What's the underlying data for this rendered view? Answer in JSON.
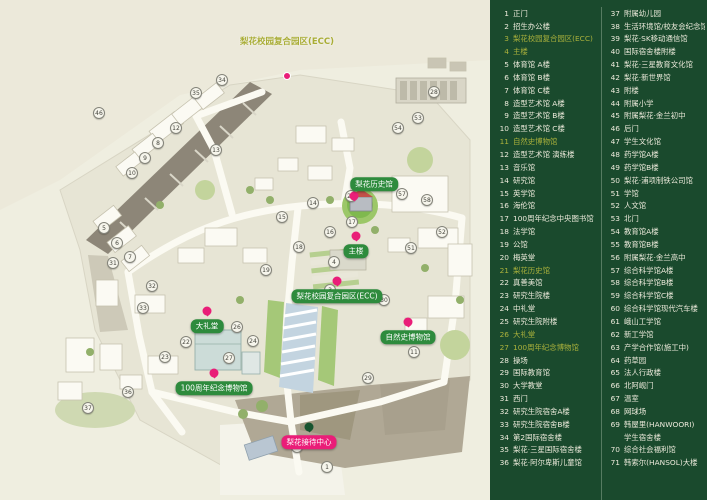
{
  "title": "梨花女子大学校园地图",
  "colors": {
    "map_bg": "#efeee0",
    "legend_bg": "#1a4a2d",
    "legend_text": "#eceadb",
    "legend_highlight": "#abb13c",
    "badge_green": "#2e8b3d",
    "badge_pink": "#ea1d78",
    "pin_pink": "#e91e78",
    "pin_green": "#17542f",
    "road": "#fbfaf2",
    "dark_band": "#8d8678",
    "lawn_green": "#7fb94e"
  },
  "map": {
    "top_label": "梨花校园复合园区(ECC)",
    "badges": [
      {
        "label": "梨花历史馆",
        "x": 374,
        "y": 184,
        "style": "green",
        "pin": "below",
        "pin_color": "pink"
      },
      {
        "label": "主楼",
        "x": 356,
        "y": 251,
        "style": "green",
        "pin": "above",
        "pin_color": "pink"
      },
      {
        "label": "梨花校园复合园区(ECC)",
        "x": 337,
        "y": 296,
        "style": "green",
        "pin": "above",
        "pin_color": "pink"
      },
      {
        "label": "大礼堂",
        "x": 207,
        "y": 326,
        "style": "green",
        "pin": "above",
        "pin_color": "pink"
      },
      {
        "label": "自然史博物馆",
        "x": 408,
        "y": 337,
        "style": "green",
        "pin": "above",
        "pin_color": "pink"
      },
      {
        "label": "100周年纪念博物馆",
        "x": 214,
        "y": 388,
        "style": "green",
        "pin": "above",
        "pin_color": "pink"
      },
      {
        "label": "梨花接待中心",
        "x": 309,
        "y": 442,
        "style": "pink",
        "pin": "above",
        "pin_color": "green"
      }
    ],
    "markers": [
      {
        "n": "46",
        "x": 99,
        "y": 113
      },
      {
        "n": "34",
        "x": 222,
        "y": 80
      },
      {
        "n": "35",
        "x": 196,
        "y": 93
      },
      {
        "n": "12",
        "x": 176,
        "y": 128
      },
      {
        "n": "8",
        "x": 158,
        "y": 143
      },
      {
        "n": "9",
        "x": 145,
        "y": 158
      },
      {
        "n": "10",
        "x": 132,
        "y": 173
      },
      {
        "n": "13",
        "x": 216,
        "y": 150
      },
      {
        "n": "5",
        "x": 104,
        "y": 228
      },
      {
        "n": "6",
        "x": 117,
        "y": 243
      },
      {
        "n": "7",
        "x": 130,
        "y": 257
      },
      {
        "n": "31",
        "x": 113,
        "y": 263
      },
      {
        "n": "32",
        "x": 152,
        "y": 286
      },
      {
        "n": "33",
        "x": 143,
        "y": 308
      },
      {
        "n": "14",
        "x": 313,
        "y": 203
      },
      {
        "n": "21",
        "x": 351,
        "y": 196
      },
      {
        "n": "17",
        "x": 352,
        "y": 222
      },
      {
        "n": "15",
        "x": 282,
        "y": 217
      },
      {
        "n": "16",
        "x": 330,
        "y": 232
      },
      {
        "n": "18",
        "x": 299,
        "y": 247
      },
      {
        "n": "4",
        "x": 334,
        "y": 262
      },
      {
        "n": "19",
        "x": 266,
        "y": 270
      },
      {
        "n": "54",
        "x": 398,
        "y": 128
      },
      {
        "n": "53",
        "x": 418,
        "y": 118
      },
      {
        "n": "28",
        "x": 434,
        "y": 92
      },
      {
        "n": "57",
        "x": 402,
        "y": 194
      },
      {
        "n": "58",
        "x": 427,
        "y": 200
      },
      {
        "n": "52",
        "x": 442,
        "y": 232
      },
      {
        "n": "51",
        "x": 411,
        "y": 248
      },
      {
        "n": "30",
        "x": 384,
        "y": 300
      },
      {
        "n": "29",
        "x": 368,
        "y": 378
      },
      {
        "n": "11",
        "x": 414,
        "y": 352
      },
      {
        "n": "26",
        "x": 237,
        "y": 327
      },
      {
        "n": "24",
        "x": 253,
        "y": 341
      },
      {
        "n": "27",
        "x": 229,
        "y": 358
      },
      {
        "n": "22",
        "x": 186,
        "y": 342
      },
      {
        "n": "23",
        "x": 165,
        "y": 357
      },
      {
        "n": "36",
        "x": 128,
        "y": 392
      },
      {
        "n": "37",
        "x": 88,
        "y": 408
      },
      {
        "n": "2",
        "x": 297,
        "y": 447
      },
      {
        "n": "1",
        "x": 327,
        "y": 467
      },
      {
        "n": "3",
        "x": 330,
        "y": 290
      }
    ]
  },
  "legend": {
    "columns": [
      {
        "items": [
          {
            "n": "1",
            "label": "正门",
            "hl": false
          },
          {
            "n": "2",
            "label": "招生办公楼",
            "hl": false
          },
          {
            "n": "3",
            "label": "梨花校园复合园区(ECC)",
            "hl": true
          },
          {
            "n": "4",
            "label": "主楼",
            "hl": true
          },
          {
            "n": "5",
            "label": "体育馆 A楼",
            "hl": false
          },
          {
            "n": "6",
            "label": "体育馆 B楼",
            "hl": false
          },
          {
            "n": "7",
            "label": "体育馆 C楼",
            "hl": false
          },
          {
            "n": "8",
            "label": "造型艺术馆 A楼",
            "hl": false
          },
          {
            "n": "9",
            "label": "造型艺术馆 B楼",
            "hl": false
          },
          {
            "n": "10",
            "label": "造型艺术馆 C楼",
            "hl": false
          },
          {
            "n": "11",
            "label": "自然史博物馆",
            "hl": true
          },
          {
            "n": "12",
            "label": "造型艺术馆 演练楼",
            "hl": false
          },
          {
            "n": "13",
            "label": "音乐馆",
            "hl": false
          },
          {
            "n": "14",
            "label": "研究馆",
            "hl": false
          },
          {
            "n": "15",
            "label": "英学馆",
            "hl": false
          },
          {
            "n": "16",
            "label": "海伦馆",
            "hl": false
          },
          {
            "n": "17",
            "label": "100周年纪念中央图书馆",
            "hl": false
          },
          {
            "n": "18",
            "label": "法学馆",
            "hl": false
          },
          {
            "n": "19",
            "label": "公馆",
            "hl": false
          },
          {
            "n": "20",
            "label": "梅英堂",
            "hl": false
          },
          {
            "n": "21",
            "label": "梨花历史馆",
            "hl": true
          },
          {
            "n": "22",
            "label": "真善美馆",
            "hl": false
          },
          {
            "n": "23",
            "label": "研究生院楼",
            "hl": false
          },
          {
            "n": "24",
            "label": "中礼堂",
            "hl": false
          },
          {
            "n": "25",
            "label": "研究生院附楼",
            "hl": false
          },
          {
            "n": "26",
            "label": "大礼堂",
            "hl": true
          },
          {
            "n": "27",
            "label": "100周年纪念博物馆",
            "hl": true
          },
          {
            "n": "28",
            "label": "操场",
            "hl": false
          },
          {
            "n": "29",
            "label": "国际教育馆",
            "hl": false
          },
          {
            "n": "30",
            "label": "大学教堂",
            "hl": false
          },
          {
            "n": "31",
            "label": "西门",
            "hl": false
          },
          {
            "n": "32",
            "label": "研究生院宿舍A楼",
            "hl": false
          },
          {
            "n": "33",
            "label": "研究生院宿舍B楼",
            "hl": false
          },
          {
            "n": "34",
            "label": "第2国际宿舍楼",
            "hl": false
          },
          {
            "n": "35",
            "label": "梨花·三星国际宿舍楼",
            "hl": false
          },
          {
            "n": "36",
            "label": "梨花·阿尔卑斯儿童馆",
            "hl": false
          }
        ]
      },
      {
        "items": [
          {
            "n": "37",
            "label": "附属幼儿园",
            "hl": false
          },
          {
            "n": "38",
            "label": "生活环境馆/校友会纪念馆",
            "hl": false
          },
          {
            "n": "39",
            "label": "梨花·SK移动通信馆",
            "hl": false
          },
          {
            "n": "40",
            "label": "国际宿舍楼附楼",
            "hl": false
          },
          {
            "n": "41",
            "label": "梨花·三星教育文化馆",
            "hl": false
          },
          {
            "n": "42",
            "label": "梨花·新世界馆",
            "hl": false
          },
          {
            "n": "43",
            "label": "附楼",
            "hl": false
          },
          {
            "n": "44",
            "label": "附属小学",
            "hl": false
          },
          {
            "n": "45",
            "label": "附属梨花·金兰初中",
            "hl": false
          },
          {
            "n": "46",
            "label": "后门",
            "hl": false
          },
          {
            "n": "47",
            "label": "学生文化馆",
            "hl": false
          },
          {
            "n": "48",
            "label": "药学馆A楼",
            "hl": false
          },
          {
            "n": "49",
            "label": "药学馆B楼",
            "hl": false
          },
          {
            "n": "50",
            "label": "梨花·浦项制铁公司馆",
            "hl": false
          },
          {
            "n": "51",
            "label": "学馆",
            "hl": false
          },
          {
            "n": "52",
            "label": "人文馆",
            "hl": false
          },
          {
            "n": "53",
            "label": "北门",
            "hl": false
          },
          {
            "n": "54",
            "label": "教育馆A楼",
            "hl": false
          },
          {
            "n": "55",
            "label": "教育馆B楼",
            "hl": false
          },
          {
            "n": "56",
            "label": "附属梨花·金兰高中",
            "hl": false
          },
          {
            "n": "57",
            "label": "综合科学馆A楼",
            "hl": false
          },
          {
            "n": "58",
            "label": "综合科学馆B楼",
            "hl": false
          },
          {
            "n": "59",
            "label": "综合科学馆C楼",
            "hl": false
          },
          {
            "n": "60",
            "label": "综合科学馆现代汽车楼",
            "hl": false
          },
          {
            "n": "61",
            "label": "峨山工学馆",
            "hl": false
          },
          {
            "n": "62",
            "label": "新工学馆",
            "hl": false
          },
          {
            "n": "63",
            "label": "产学合作馆(施工中)",
            "hl": false
          },
          {
            "n": "64",
            "label": "药草园",
            "hl": false
          },
          {
            "n": "65",
            "label": "法人行政楼",
            "hl": false
          },
          {
            "n": "66",
            "label": "北阿岘门",
            "hl": false
          },
          {
            "n": "67",
            "label": "温室",
            "hl": false
          },
          {
            "n": "68",
            "label": "网球场",
            "hl": false
          },
          {
            "n": "69",
            "label": "韩屋里(HANWOORI)",
            "hl": false
          },
          {
            "n": "",
            "label": "学生宿舍楼",
            "hl": false
          },
          {
            "n": "70",
            "label": "综合社会福利馆",
            "hl": false
          },
          {
            "n": "71",
            "label": "韩索尔(HANSOL)大楼",
            "hl": false
          }
        ]
      }
    ]
  }
}
